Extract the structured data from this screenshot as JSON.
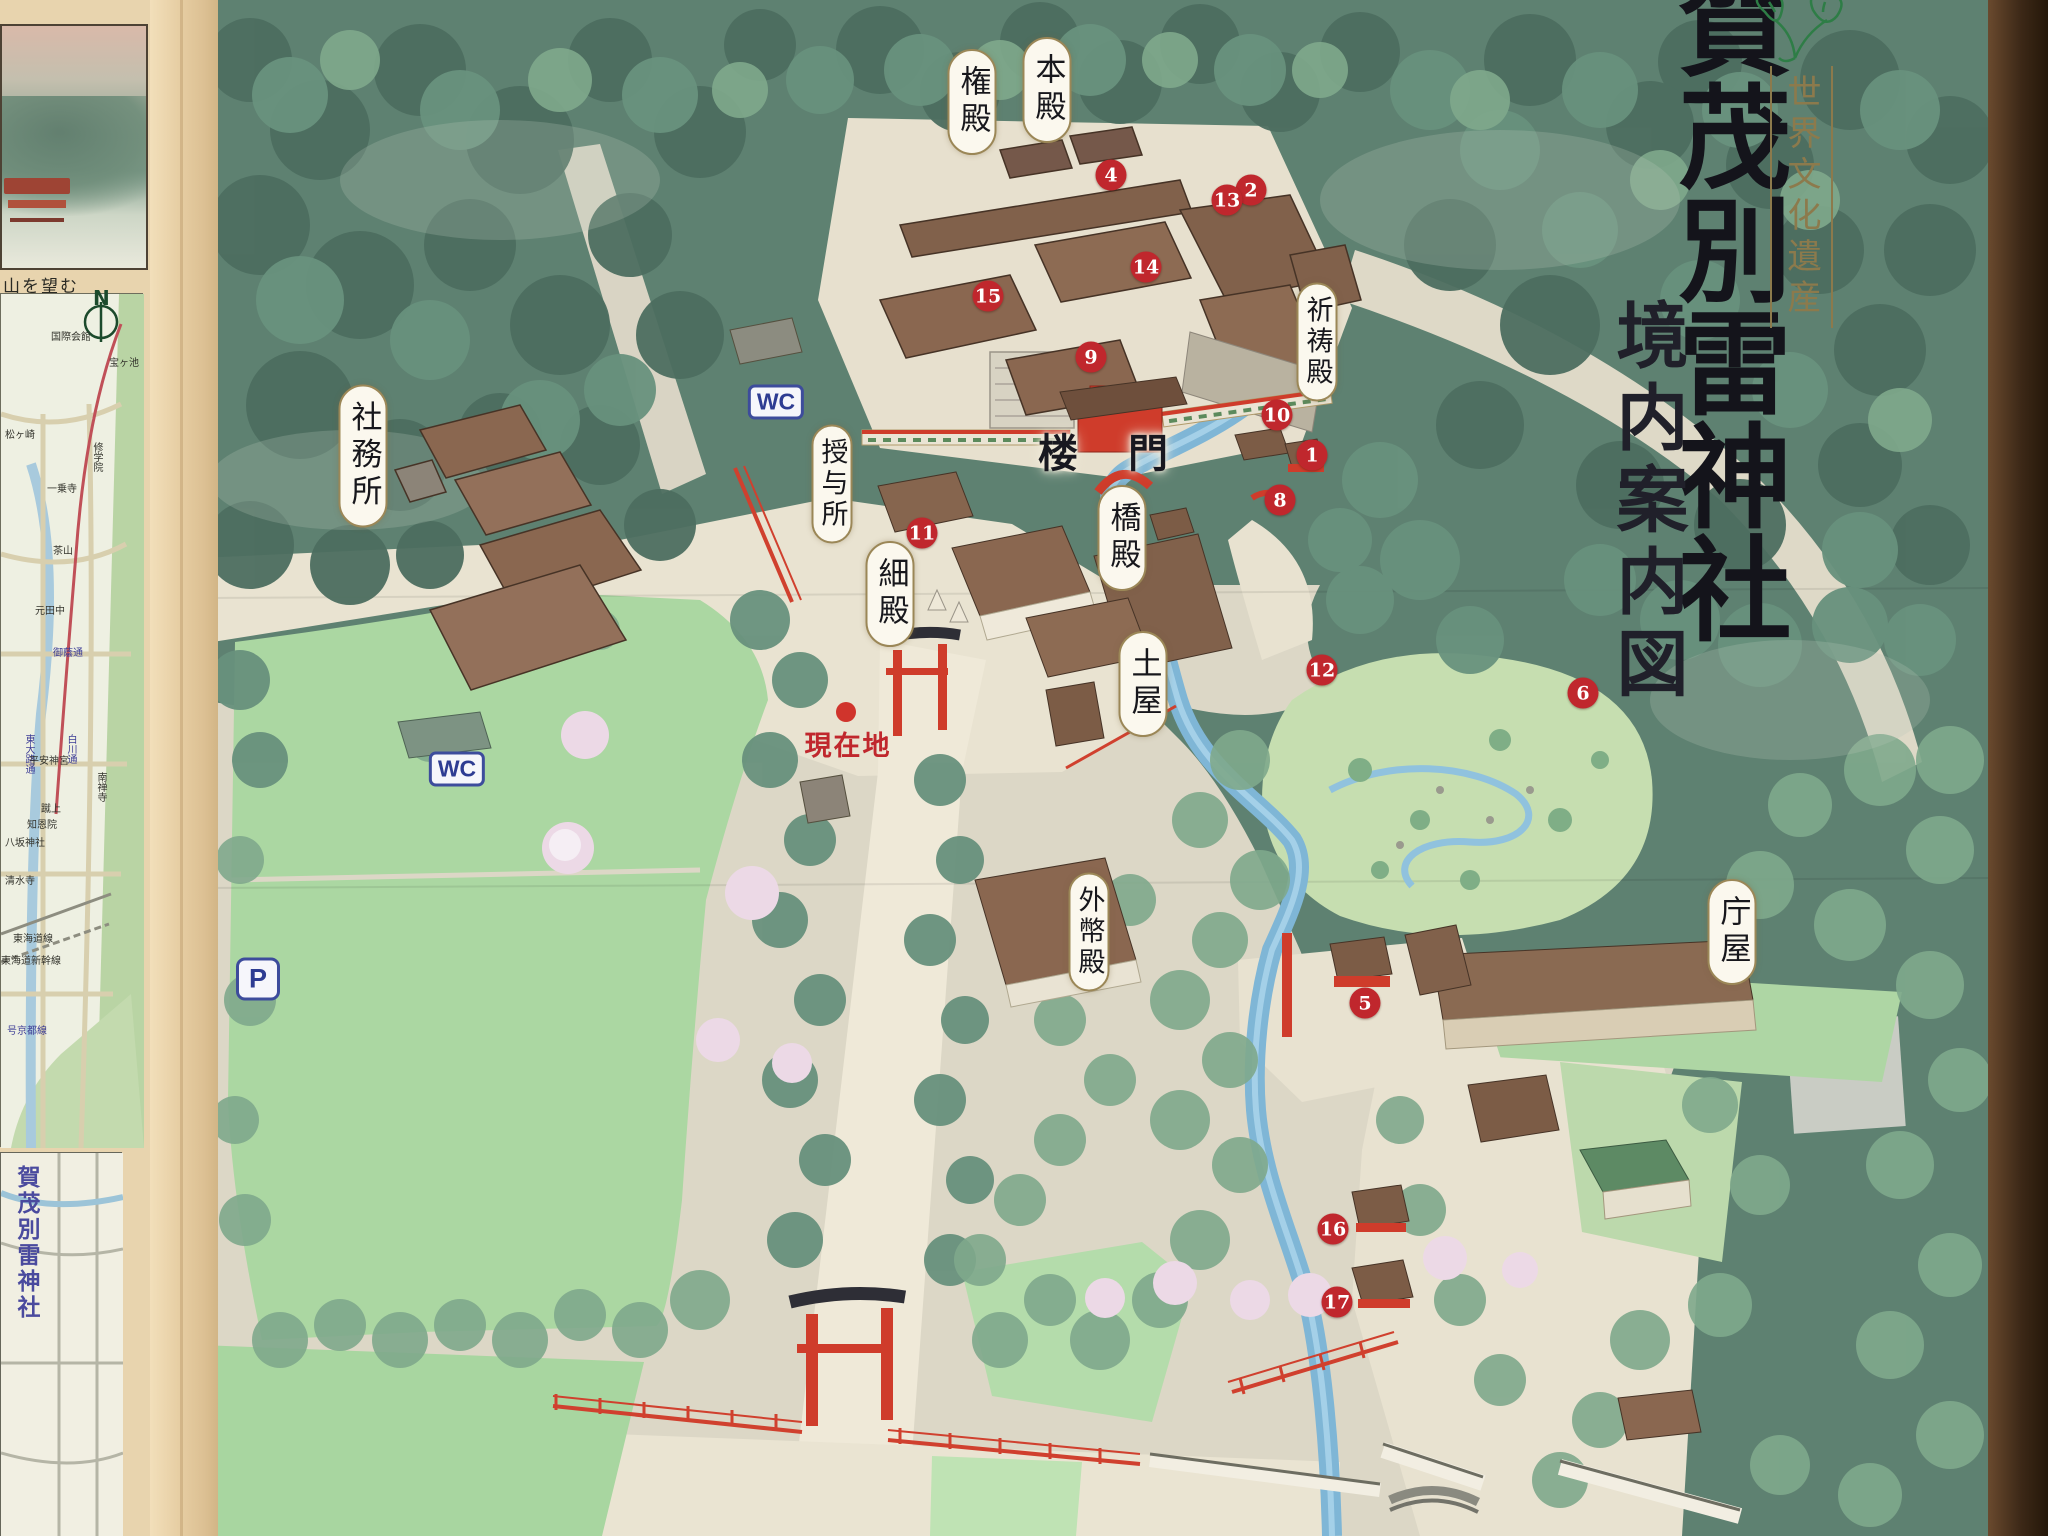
{
  "board": {
    "title_main": "賀茂別雷神社",
    "heritage_badge": "世界文化遺産",
    "map_title": "境内案内図",
    "current_location": "現在地"
  },
  "labels": {
    "honden": "本殿",
    "gonden": "権殿",
    "kitoden": "祈祷殿",
    "romon": "楼 門",
    "hashidono": "橋殿",
    "hosodono": "細殿",
    "tsuchinoya": "土屋",
    "gaiheiden": "外幣殿",
    "shamusho": "社務所",
    "juyosho": "授与所",
    "choya": "庁屋"
  },
  "badges": {
    "wc": "WC",
    "parking": "P",
    "north": "N"
  },
  "markers": {
    "m1": "1",
    "m2": "2",
    "m4": "4",
    "m5": "5",
    "m6": "6",
    "m8": "8",
    "m9": "9",
    "m10": "10",
    "m11": "11",
    "m12": "12",
    "m13": "13",
    "m14": "14",
    "m15": "15",
    "m16": "16",
    "m17": "17"
  },
  "sidebar": {
    "painting_caption": "山を望む",
    "roadmap_labels": [
      "国際会館",
      "宝ヶ池",
      "松ヶ崎",
      "修学院",
      "一乗寺",
      "茶山",
      "元田中",
      "御蔭通",
      "東大路通",
      "白川通",
      "平安神宮",
      "南禅寺",
      "蹴上",
      "知恩院",
      "八坂神社",
      "清水寺",
      "東海道線",
      "東海道新幹線",
      "号京都線"
    ],
    "area_map_title": "賀茂別雷神社"
  },
  "colors": {
    "marker_red": "#c0272d",
    "vermilion": "#cf3c2b",
    "forest_green": "#4d6e60",
    "lawn_green": "#abd7a2",
    "stream_blue": "#7fb6d6",
    "heritage_gold": "#8c7a4c"
  }
}
